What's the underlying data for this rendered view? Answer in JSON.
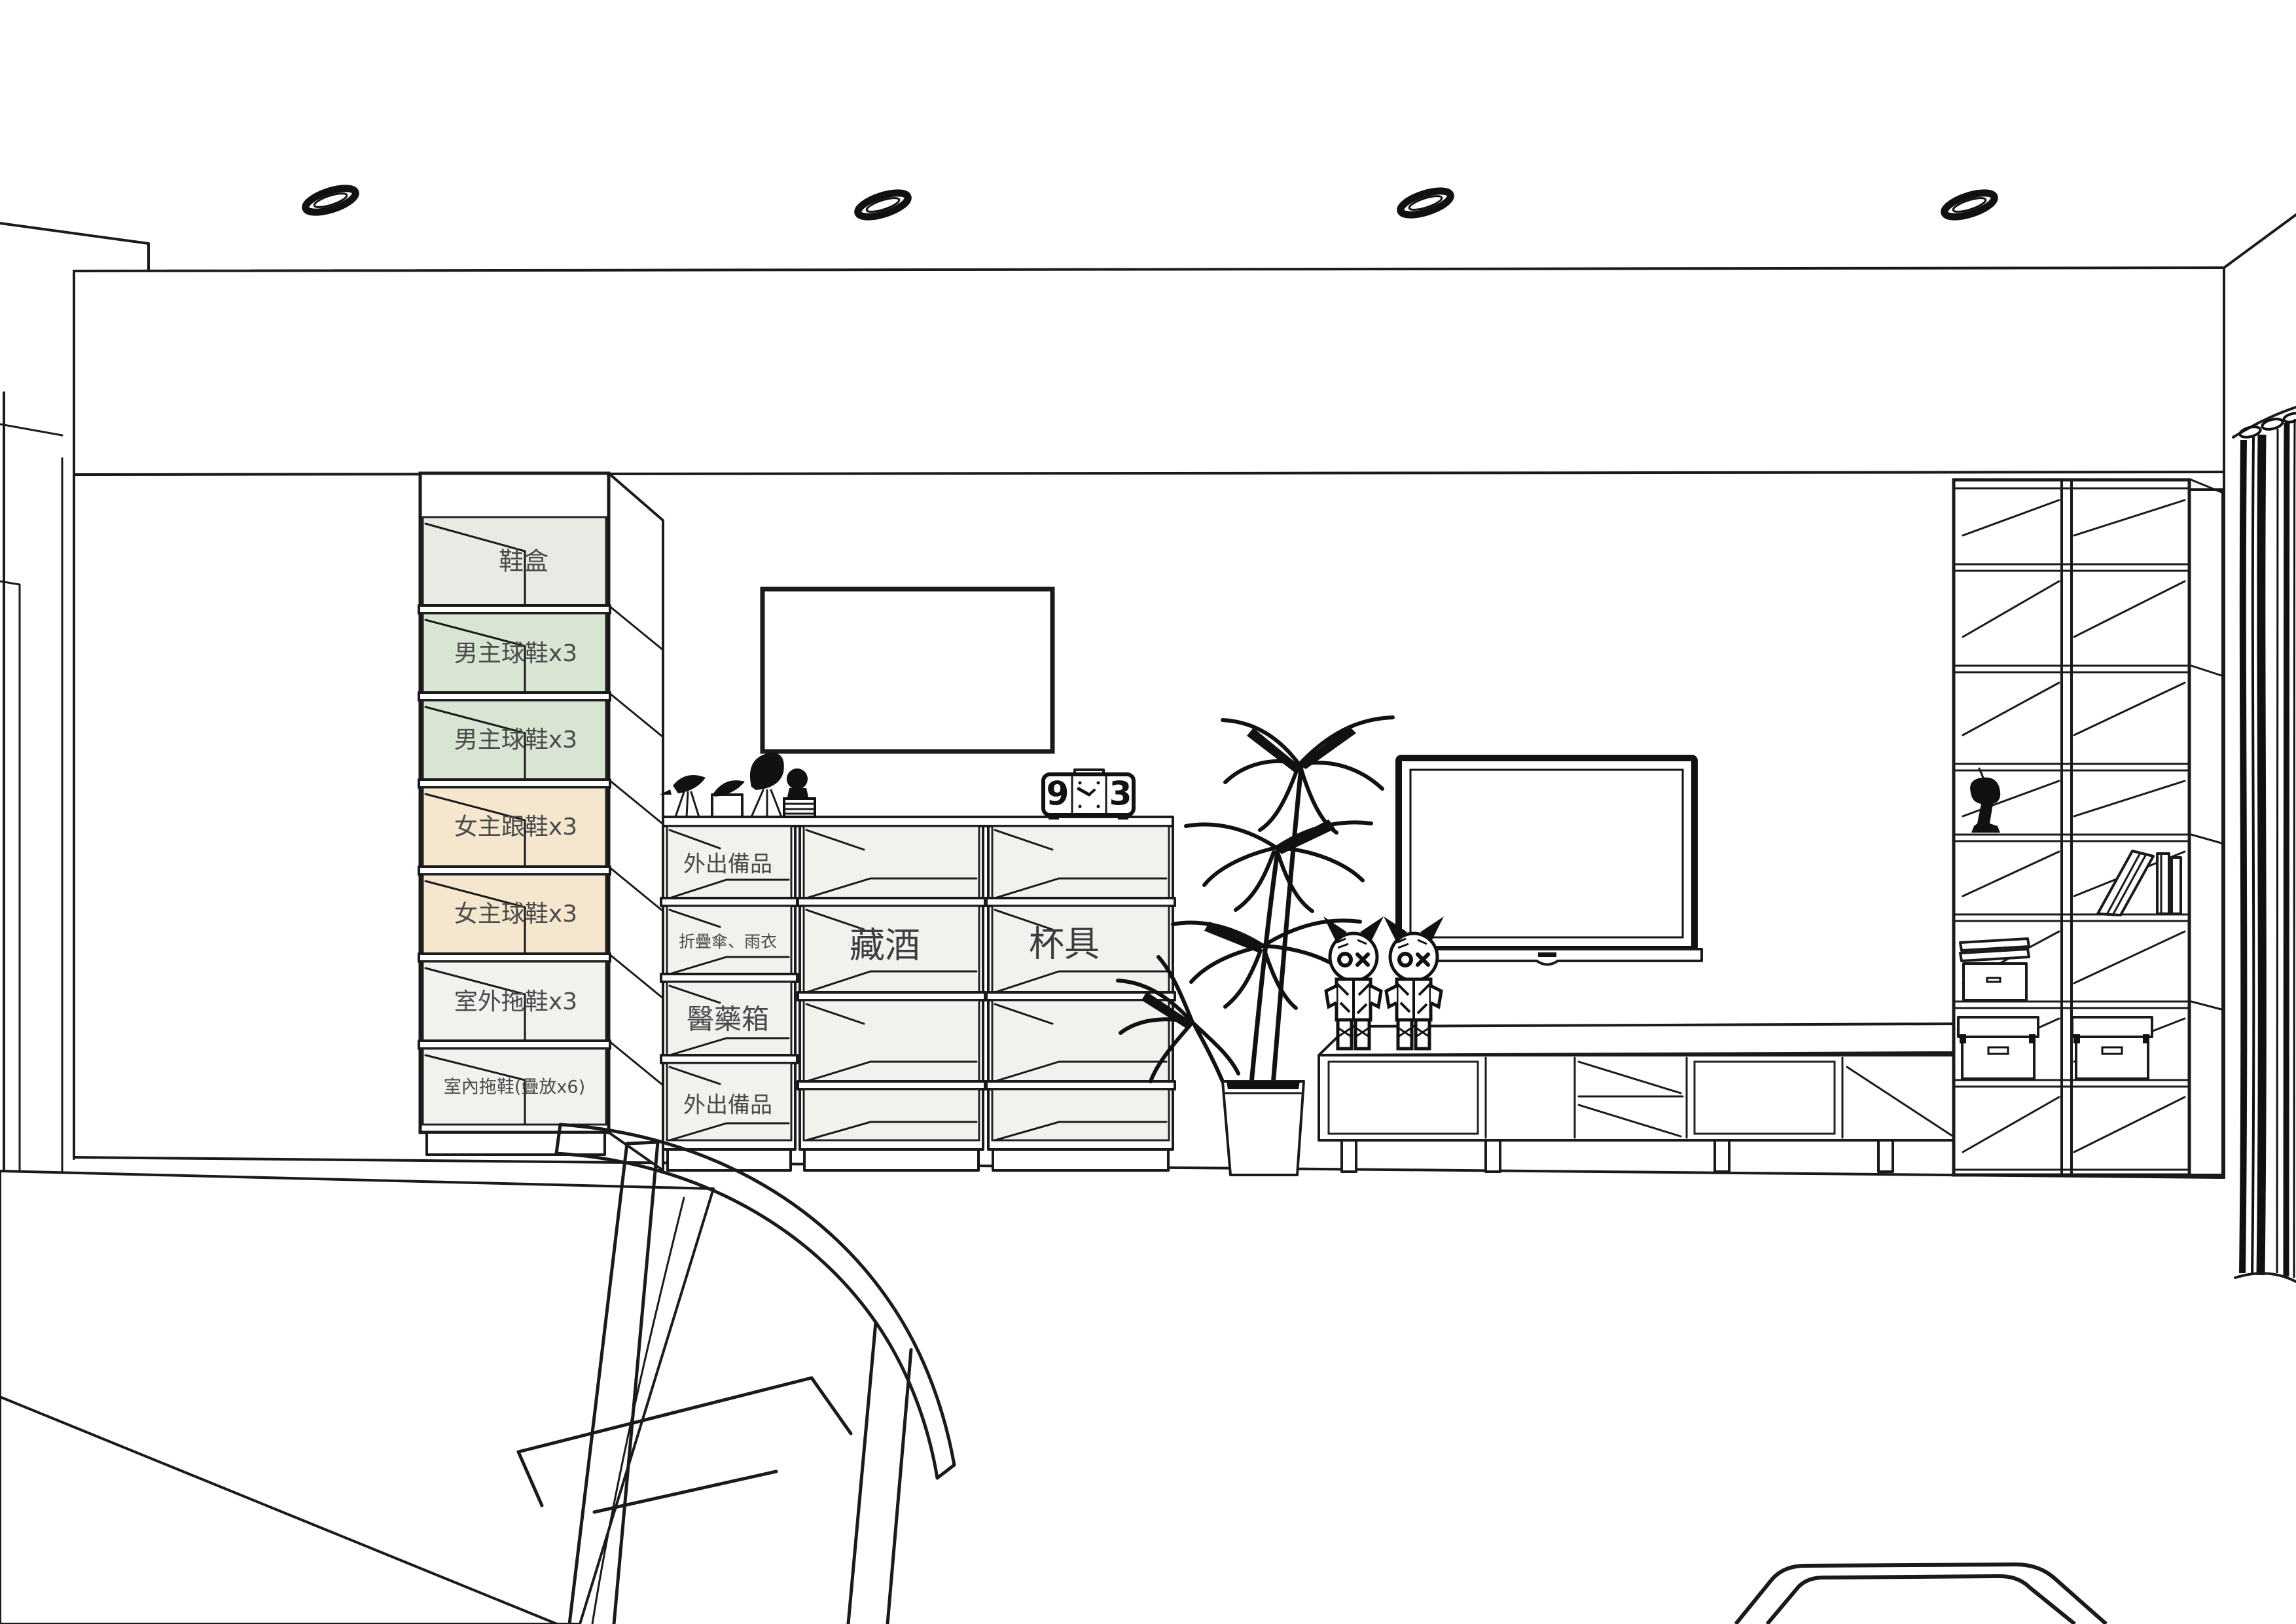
{
  "colors": {
    "line": "#1a1a1a",
    "label": "#4a4a4a",
    "slot_gray": "#eae9e4",
    "slot_green": "#d8e5d3",
    "slot_tan": "#f4e7ce",
    "slot_white": "#f2f1ee",
    "cell_white": "#f2f1ee"
  },
  "shoe_cabinet": {
    "slots": [
      {
        "label": "鞋盒",
        "tone": "gray"
      },
      {
        "label": "男主球鞋x3",
        "tone": "green"
      },
      {
        "label": "男主球鞋x3",
        "tone": "green"
      },
      {
        "label": "女主跟鞋x3",
        "tone": "tan"
      },
      {
        "label": "女主球鞋x3",
        "tone": "tan"
      },
      {
        "label": "室外拖鞋x3",
        "tone": "white"
      },
      {
        "label": "室內拖鞋(疊放x6)",
        "tone": "white"
      }
    ]
  },
  "entry_shelf": {
    "left_rows": [
      "外出備品",
      "折疊傘、雨衣",
      "醫藥箱",
      "外出備品"
    ],
    "wine_label": "藏酒",
    "cup_label": "杯具"
  },
  "clock": {
    "left_digit": "9",
    "right_digit": "3"
  }
}
